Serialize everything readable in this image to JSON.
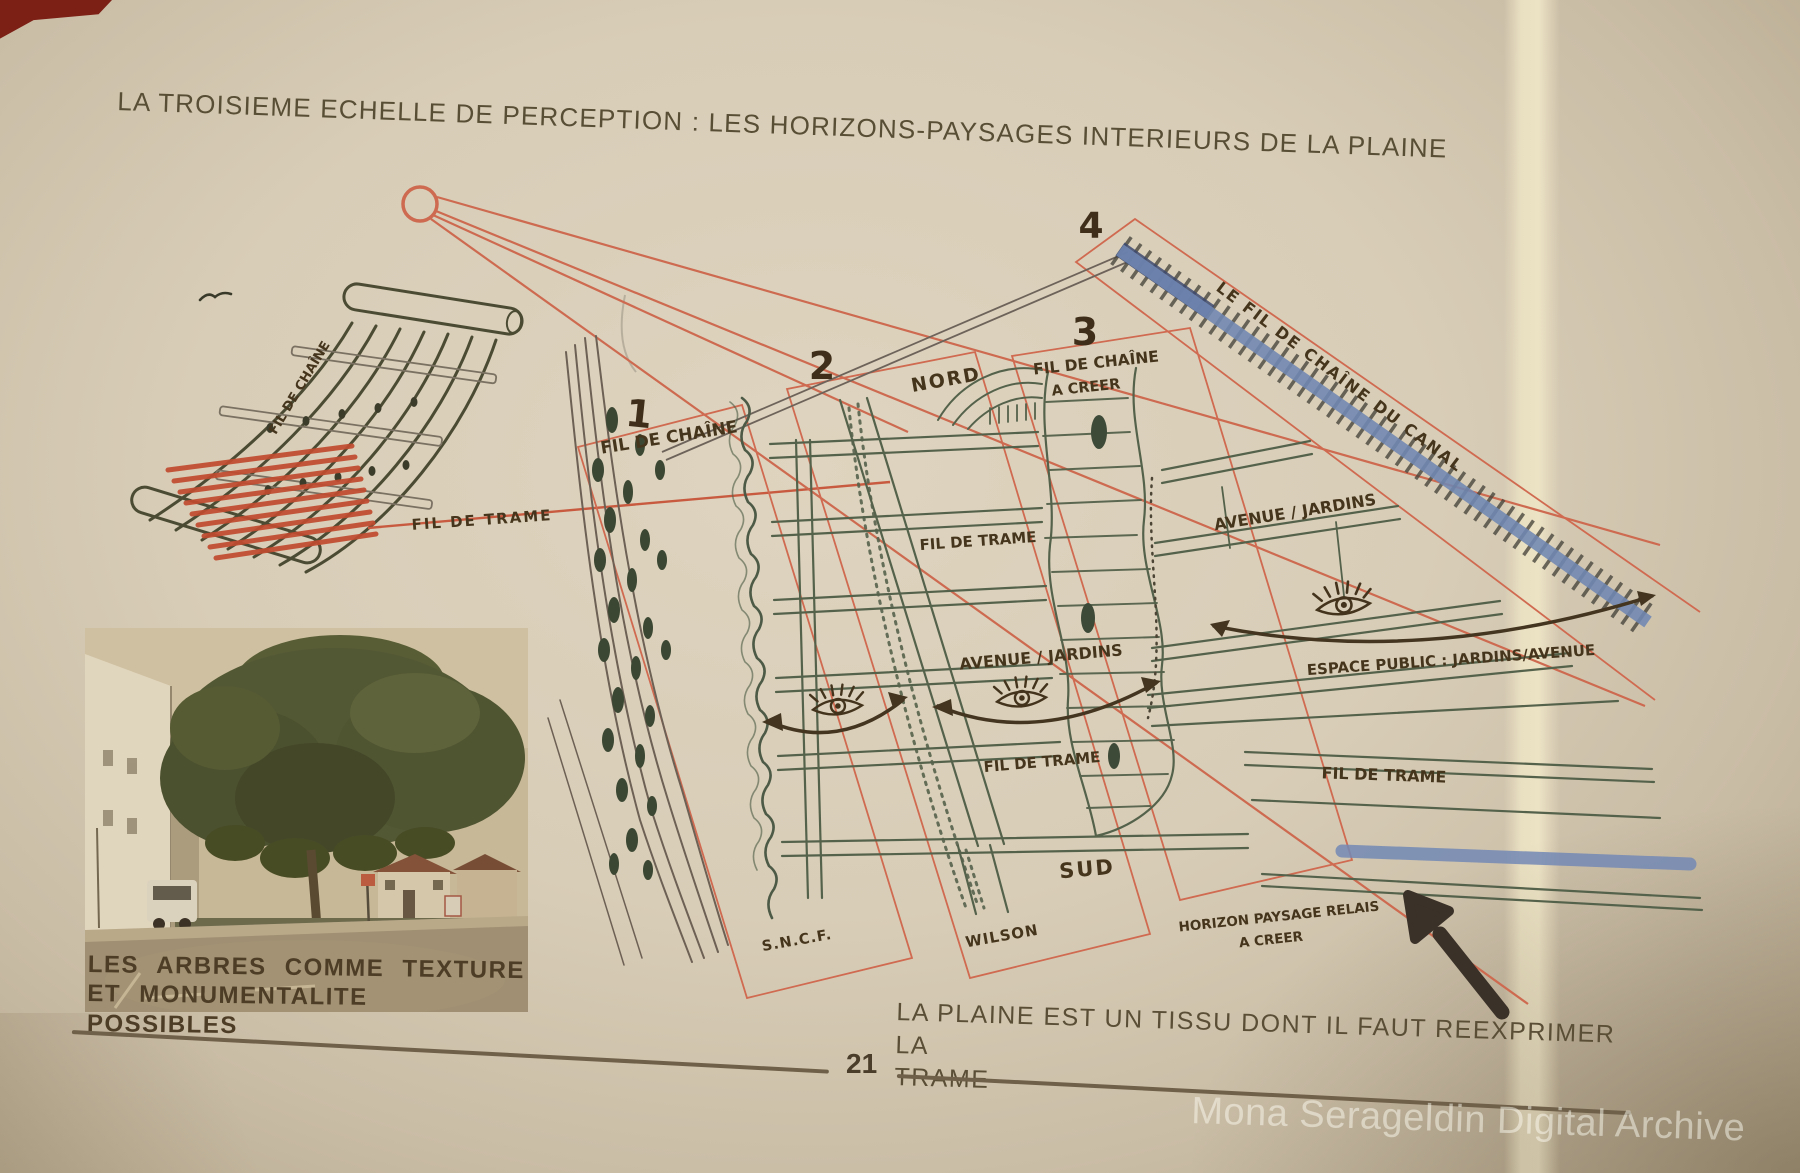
{
  "slide": {
    "title": "LA TROISIEME ECHELLE DE PERCEPTION : LES HORIZONS-PAYSAGES INTERIEURS DE LA PLAINE",
    "statement_line1": "LA PLAINE EST UN TISSU DONT IL FAUT REEXPRIMER LA",
    "statement_line2": "TRAME",
    "page_number": "21",
    "watermark": "Mona Serageldin Digital Archive"
  },
  "loom_diagram": {
    "warp_label": "FIL DE CHAÎNE",
    "weft_label": "FIL DE TRAME"
  },
  "photo": {
    "caption_line1": "LES ARBRES COMME TEXTURE",
    "caption_line2": "ET MONUMENTALITE POSSIBLES"
  },
  "map": {
    "band_1_number": "1",
    "band_1_label": "FIL DE CHAÎNE",
    "band_2_number": "2",
    "band_3_number": "3",
    "band_3_label_line1": "FIL DE CHAÎNE",
    "band_3_label_line2": "A CREER",
    "band_4_number": "4",
    "canal_label": "LE FIL DE CHAÎNE DU CANAL",
    "north_label": "NORD",
    "south_label": "SUD",
    "trame_label_upper": "FIL DE TRAME",
    "trame_label_lower": "FIL DE TRAME",
    "trame_label_right": "FIL DE TRAME",
    "avenue_label_upper": "AVENUE / JARDINS",
    "avenue_label_middle": "AVENUE / JARDINS",
    "espace_public_label": "ESPACE PUBLIC : JARDINS/AVENUE",
    "sncf_label": "S.N.C.F.",
    "wilson_label": "WILSON",
    "horizon_label_line1": "HORIZON PAYSAGE RELAIS",
    "horizon_label_line2": "A CREER"
  },
  "colors": {
    "paper": "#d8cdb7",
    "ink_olive": "#55624b",
    "ink_brown": "#46361f",
    "accent_red": "#cc5f45",
    "canal_blue": "#6f87b3",
    "typed_text": "#5a4f36"
  }
}
